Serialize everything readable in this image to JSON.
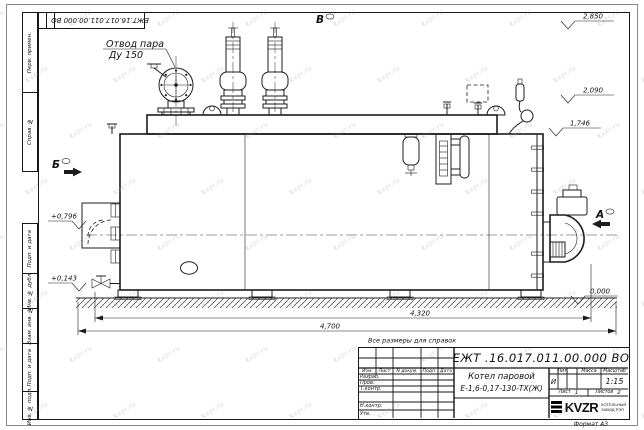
{
  "watermark": "kvzr.ru",
  "stamp_top": "ЕЖТ.16.017.011.00.000  ВО",
  "drawing": {
    "steam_label_1": "Отвод пара",
    "steam_label_2": "Ду 150",
    "view_b": "Б",
    "view_v": "В",
    "view_a": "А",
    "elev_2850": "2,850",
    "elev_2090": "2,090",
    "elev_1746": "1,746",
    "elev_0000": "0,000",
    "elev_0796": "+0,796",
    "elev_0143": "+0,143",
    "dim_4320": "4,320",
    "dim_4700": "4,700",
    "note": "Все размеры для справок"
  },
  "frame_labels": {
    "perv": "Перв. примен.",
    "sprav": "Справ. №",
    "podp1": "Подп. и дата",
    "inv_dubl": "Инв. № дубл.",
    "vzam": "Взам. инв. №",
    "podp2": "Подп. и дата",
    "inv_podl": "Инв. № подл.",
    "format": "Формат А3"
  },
  "title_block": {
    "doc_number": "ЕЖТ .16.017.011.00.000  ВО",
    "name_line1": "Котел паровой",
    "name_line2": "Е-1,6-0,17-130-ТХ(Ж)",
    "col_izm": "Изм.",
    "col_list": "Лист",
    "col_ndoc": "N докум.",
    "col_podp": "Подп.",
    "col_data": "Дата",
    "row_razrab": "Разраб.",
    "row_prov": "Пров.",
    "row_tkontr": "Т.контр.",
    "row_nkontr": "Н.контр.",
    "row_utv": "Утв.",
    "lit_header": "Лит.",
    "mass_header": "Масса",
    "scale_header": "Масштаб",
    "lit_value": "И",
    "scale_value": "1:15",
    "sheet_label": "Лист",
    "sheet_value": "1",
    "sheets_label": "Листов",
    "sheets_value": "2",
    "logo_text": "KVZR",
    "logo_sub1": "КОТЕЛЬНЫЙ",
    "logo_sub2": "ЗАВОД РЭП"
  }
}
